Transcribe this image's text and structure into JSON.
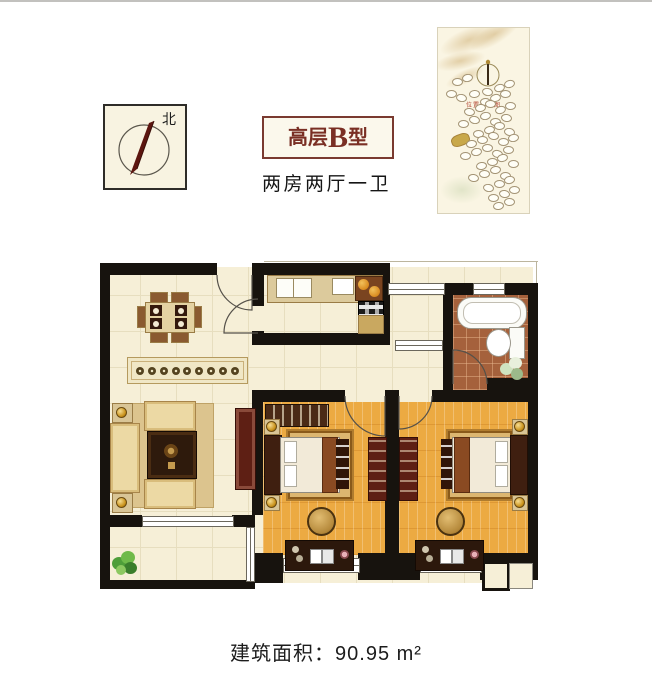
{
  "compass": {
    "north_label": "北"
  },
  "title_box": {
    "prefix": "高层",
    "letter": "B",
    "suffix": "型"
  },
  "subtitle": "两房两厅一卫",
  "site_plan": {
    "caption": "位置示意图"
  },
  "footer": {
    "area_text": "建筑面积：90.95 m²"
  },
  "colors": {
    "accent": "#7a2f24",
    "title_border": "#7a3a30",
    "wall": "#17130e",
    "floor_cream": "#f6efd7",
    "floor_grid": "#e7debf",
    "wood": "#ecaa42",
    "tile": "#a5613c",
    "furniture_tan": "#d9c596",
    "furniture_dark": "#3a2113",
    "cabinet_maroon": "#5e1f14",
    "gold": "#c9a04a",
    "plant_green": "#56a23b"
  }
}
